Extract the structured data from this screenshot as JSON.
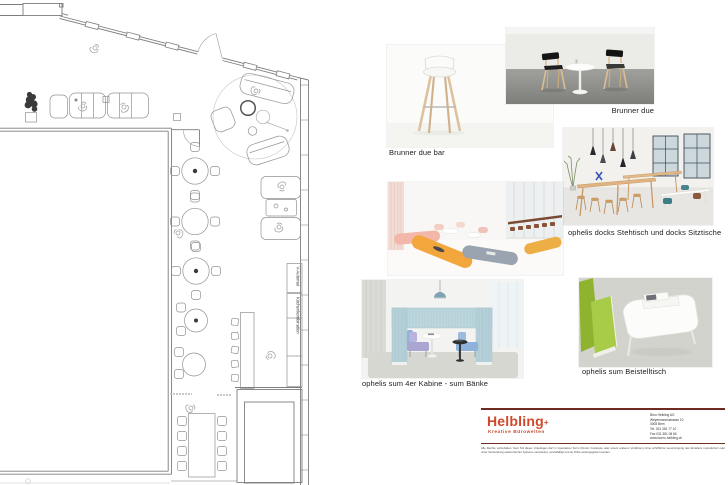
{
  "board": {
    "plan": {
      "v_automat": "V-Automat",
      "kuechenkombination": "Küchenkombination"
    },
    "products": [
      {
        "id": "brunner-due-bar",
        "label": "Brunner due bar"
      },
      {
        "id": "brunner-due",
        "label": "Brunner due"
      },
      {
        "id": "ophelis-docks",
        "label": "ophelis docks Stehtisch und docks Sitztische"
      },
      {
        "id": "ophelis-sum-kabine",
        "label": "ophelis sum 4er Kabine - sum Bänke"
      },
      {
        "id": "ophelis-sum-beistelltisch",
        "label": "ophelis sum Beistelltisch"
      }
    ],
    "footer": {
      "brand": "Helbling",
      "brand_suffix": "+",
      "tagline": "Kreative Bürowelten",
      "brand_color": "#D0492C",
      "rule_color": "#6E2B22",
      "address_lines": [
        "Büro Helbling AG",
        "Weyermannsstrasse 10",
        "3008 Bern",
        "Tel. 031 381 77 10",
        "Fax 031 381 08 66",
        "www.buero-helbling.ch"
      ],
      "legal": "Alle Rechte vorbehalten. Kein Teil dieser Unterlagen darf in irgendeiner Form (Druck, Fotokopie oder einem anderen Verfahren) ohne schriftliche Genehmigung des Erstellers reproduziert oder unter Verwendung elektronischer Systeme verarbeitet, vervielfältigt und an Dritte weitergegeben werden."
    }
  }
}
